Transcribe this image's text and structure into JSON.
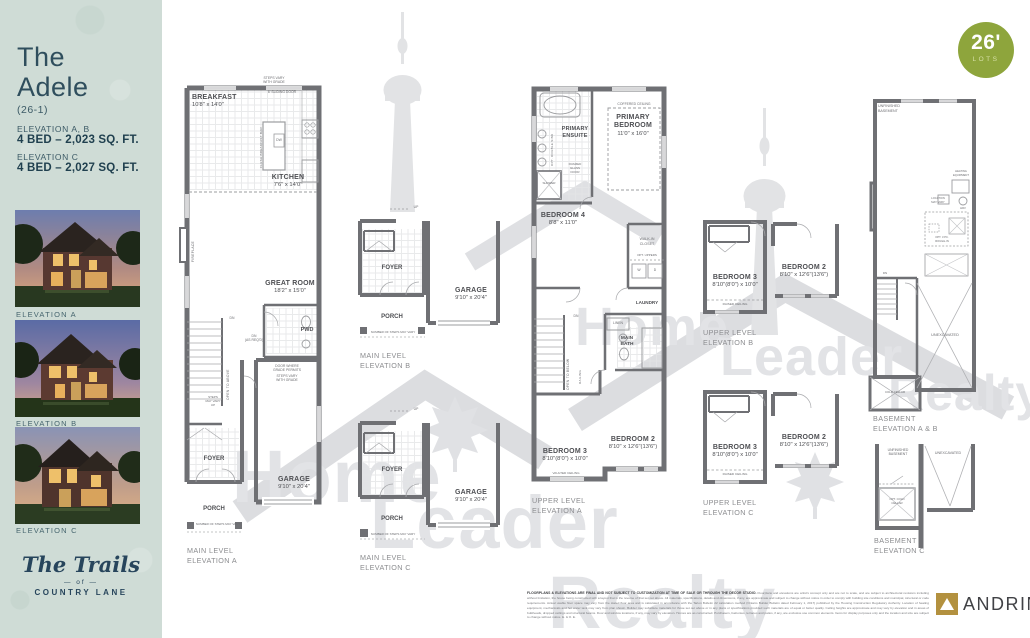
{
  "badge": {
    "size": "26'",
    "label": "LOTS"
  },
  "sidebar": {
    "title1": "The",
    "title2": "Adele",
    "lot": "(26-1)",
    "spec1_label": "ELEVATION A, B",
    "spec1_value": "4 BED – 2,023 SQ. FT.",
    "spec2_label": "ELEVATION C",
    "spec2_value": "4 BED – 2,027 SQ. FT.",
    "photo_captions": [
      "ELEVATION A",
      "ELEVATION B",
      "ELEVATION C"
    ],
    "brand_script": "The Trails",
    "brand_of": "—  of  —",
    "brand_name": "COUNTRY LANE"
  },
  "watermark": {
    "words": [
      "Home",
      "Leader",
      "Realty"
    ]
  },
  "plans": {
    "main_a": {
      "caption": "MAIN LEVEL\nELEVATION A",
      "breakfast": "BREAKFAST",
      "breakfast_dims": "10'8\" x 14'0\"",
      "kitchen": "KITCHEN",
      "kitchen_dims": "7'6\" x 14'0\"",
      "great": "GREAT ROOM",
      "great_dims": "18'2\" x 15'0\"",
      "garage": "GARAGE",
      "garage_dims": "9'10\" x 20'4\"",
      "foyer": "FOYER",
      "porch": "PORCH",
      "pwd": "PWD",
      "sliding": "6' SLIDING DOOR",
      "steps_grade_top": "STEPS VARY\nWITH GRADE",
      "flush_bar": "FLUSH BREAKFAST BAR",
      "dw": "DW",
      "fireplace": "FIREPLACE",
      "dn": "DN",
      "dn_req": "DN\n(AS REQ'D)",
      "door_grade": "DOOR WHERE\nGRADE PERMITS",
      "steps_grade": "STEPS VARY\nWITH GRADE",
      "open_above": "OPEN TO ABOVE",
      "steps_up": "STEPS\nMAY VARY\nUP",
      "num_steps": "NUMBER OF STEPS MAY VARY"
    },
    "main_b": {
      "caption": "MAIN LEVEL\nELEVATION B",
      "foyer": "FOYER",
      "porch": "PORCH",
      "garage": "GARAGE",
      "garage_dims": "9'10\" x 20'4\"",
      "up": "UP",
      "num_steps": "NUMBER OF STEPS MAY VARY"
    },
    "main_c": {
      "caption": "MAIN LEVEL\nELEVATION C",
      "foyer": "FOYER",
      "porch": "PORCH",
      "garage": "GARAGE",
      "garage_dims": "9'10\" x 20'4\"",
      "up": "UP",
      "num_steps": "NUMBER OF STEPS MAY VARY"
    },
    "upper_a": {
      "caption": "UPPER LEVEL\nELEVATION A",
      "primary": "PRIMARY\nBEDROOM",
      "primary_dims": "11'0\" x 16'0\"",
      "coffered": "COFFERED CEILING",
      "ensuite": "PRIMARY\nENSUITE",
      "opt_sink": "OPT. DOUBLE SINK",
      "shower": "SHOWER",
      "framed": "FRAMED\nGLASS\nDOOR",
      "bed4": "BEDROOM 4",
      "bed4_dims": "8'8\" x 11'0\"",
      "wic": "WALK-IN\nCLOSET",
      "opt_uppers": "OPT. UPPERS",
      "w": "W",
      "d": "D",
      "laundry": "LAUNDRY",
      "linen": "LINEN",
      "main_bath": "MAIN\nBATH",
      "dn": "DN",
      "open_below": "OPEN TO BELOW",
      "railing": "RAILING",
      "bed3": "BEDROOM 3",
      "bed3_dims": "8'10\"(8'0\") x 10'0\"",
      "vaulted": "VAULTED CEILING",
      "bed2": "BEDROOM 2",
      "bed2_dims": "8'10\" x 12'6\"(13'6\")"
    },
    "upper_b": {
      "caption": "UPPER LEVEL\nELEVATION B",
      "bed3": "BEDROOM 3",
      "bed3_dims": "8'10\"(8'0\") x 10'0\"",
      "raised": "RAISED CEILING",
      "bed2": "BEDROOM 2",
      "bed2_dims": "8'10\" x 12'6\"(13'6\")"
    },
    "upper_c": {
      "caption": "UPPER LEVEL\nELEVATION C",
      "bed3": "BEDROOM 3",
      "bed3_dims": "8'10\"(8'0\") x 10'0\"",
      "raised": "RAISED CEILING",
      "bed2": "BEDROOM 2",
      "bed2_dims": "8'10\" x 12'6\"(13'6\")"
    },
    "bsmt_ab": {
      "caption": "BASEMENT\nELEVATION A & B",
      "unfinished": "UNFINISHED\nBASEMENT",
      "heating": "HEATING\nEQUIPMENT",
      "hrv": "HRV",
      "location": "LOCATION\nMAY VARY",
      "opt_rough": "OPT. 3 PC.\nROUGH-IN",
      "unexcavated": "UNEXCAVATED",
      "cold": "COLD CELLAR",
      "dn": "DN"
    },
    "bsmt_c": {
      "caption": "BASEMENT\nELEVATION C",
      "unfinished": "UNFINISHED\nBASEMENT",
      "unexcavated": "UNEXCAVATED",
      "opt_cold": "OPT. COLD\nCELLAR"
    }
  },
  "footer": {
    "disclaimer_lead": "FLOORPLANS & ELEVATIONS ARE FINAL AND NOT SUBJECT TO CUSTOMIZATION AT TIME OF SALE OR THROUGH THE DECOR STUDIO.",
    "disclaimer_body": "Floorplans and elevations are artist's concept only and are not to scale, and are subject to architectural revisions including without limitation, the house being constructed with a layout that is the reverse of that set out above. All materials, specifications, details and dimensions, if any, are approximate and subject to change without notice in order to comply with building site conditions and municipal, structural or code requirements. Actual usable floor space may vary from the stated floor area and is calculated in accordance with the Tarion Bulletin 22 calculation method (Ontario Builder Bulletin dated February 1, 2017) published by the Housing Construction Regulatory Authority. Location of heating equipment, mechanicals and hot water tank may vary from plan shown. Builder may substitute materials for those set out above or in any plans or specifications provided such materials are of equal or better quality. Ceiling heights are approximate and may vary by elevation and in areas of bulkheads, dropped ceilings and structural beams. Door and window locations, if any, may vary by elevation. Homes are as constructed. Purchasers, balconies, terraces and patios, if any, are exclusive use common elements. Items for display purposes only and the location and size are subject to change without notice. E. & O. E.",
    "builder": "ANDRIN"
  }
}
